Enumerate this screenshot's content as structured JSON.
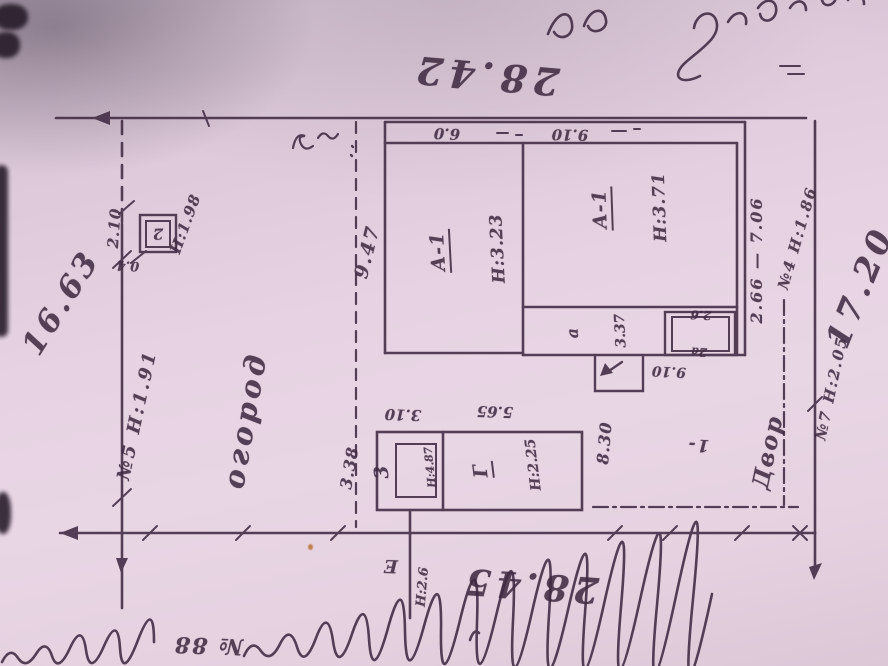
{
  "meta": {
    "description": "photographed hand-drawn land plot survey plan",
    "paper_color": "#e6d2e2",
    "ink_color": "#3f2a41"
  },
  "boundaries": {
    "top": "28.42",
    "left": "16.63",
    "bottom": "28.45",
    "right": "17.20",
    "fence5": "№5 Н:1.91",
    "fence4": "№4 Н:1.86",
    "fence7": "№7 Н:2.05",
    "fenceE": "Е",
    "fenceE_h": "Н:2.6",
    "span_right": "2.66 — 7.06"
  },
  "areas": {
    "garden": "огород",
    "yard": "Двор",
    "yard_mark": "1-"
  },
  "house": {
    "room_left": {
      "lit": "А-1",
      "h": "Н:3.23"
    },
    "room_right": {
      "lit": "А-1",
      "h": "Н:3.71"
    },
    "front_left": "6.0",
    "front_right": "9.10",
    "side": "9.47",
    "annex_lit": "а",
    "annex_len": "3.37",
    "box_lit": "2а",
    "box_dim": "2.6",
    "porch_len": "9.10"
  },
  "shed": {
    "room_small_lit": "3",
    "room_small_h": "Н:4.87",
    "room_main_lit": "Г",
    "room_main_h": "Н:2.25",
    "top_left": "3.10",
    "top_right": "5.65",
    "left": "3.38",
    "right": "8.30"
  },
  "kiosk": {
    "lit": "2",
    "h": "Н:1.98",
    "w": "2.10",
    "d": "0.4"
  },
  "caption": {
    "house_no": "№ 88"
  }
}
